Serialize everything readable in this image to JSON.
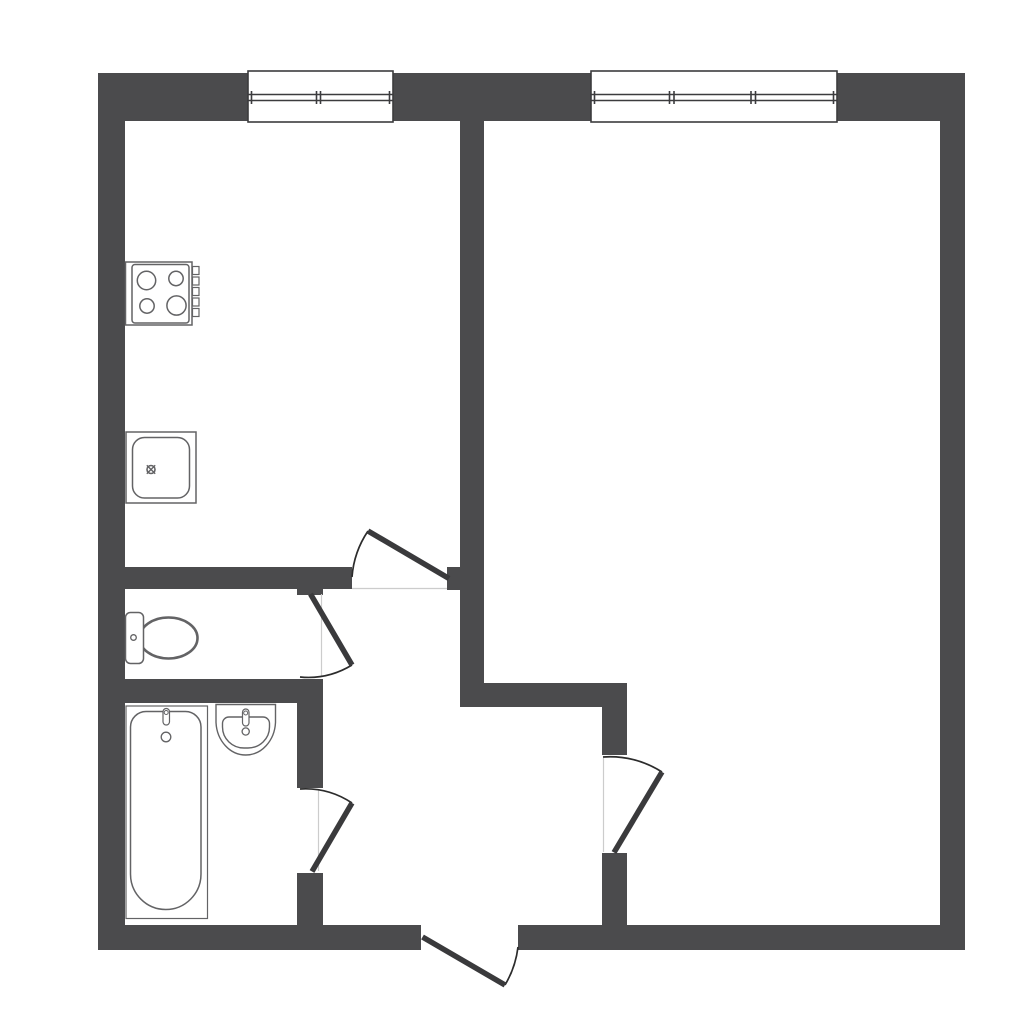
{
  "page": {
    "kind": "architectural-floor-plan",
    "text_content": "none"
  },
  "colors": {
    "background": "#ffffff",
    "wall": "#4b4b4d",
    "door_leaf": "#3a3a3c",
    "door_arc": "#2c2c2c",
    "window_frame": "#3c3c3e",
    "fixture_stroke": "#636365",
    "jamb_line": "#cccccc",
    "fixture_fill": "#ffffff"
  },
  "drawing": {
    "canvas": {
      "width": 1024,
      "height": 1024,
      "viewBox": "0 0 1024 1024"
    },
    "layers": [
      {
        "name": "walls",
        "style": {
          "fill": "#4b4b4d",
          "stroke": "none"
        },
        "shapes": [
          {
            "tag": "rect",
            "name": "wall-exterior-top",
            "attrs": {
              "x": 98,
              "y": 73,
              "width": 867,
              "height": 48
            }
          },
          {
            "tag": "rect",
            "name": "wall-exterior-left",
            "attrs": {
              "x": 98,
              "y": 73,
              "width": 27,
              "height": 877
            }
          },
          {
            "tag": "rect",
            "name": "wall-exterior-right",
            "attrs": {
              "x": 940,
              "y": 73,
              "width": 25,
              "height": 877
            }
          },
          {
            "tag": "rect",
            "name": "wall-exterior-bottom-left",
            "attrs": {
              "x": 98,
              "y": 925,
              "width": 323,
              "height": 25
            }
          },
          {
            "tag": "rect",
            "name": "wall-exterior-bottom-right",
            "attrs": {
              "x": 518,
              "y": 925,
              "width": 447,
              "height": 25
            }
          },
          {
            "tag": "rect",
            "name": "wall-core-vertical",
            "attrs": {
              "x": 460,
              "y": 121,
              "width": 24,
              "height": 586
            }
          },
          {
            "tag": "rect",
            "name": "wall-kitchen-door-stub",
            "attrs": {
              "x": 447,
              "y": 567,
              "width": 13,
              "height": 23
            }
          },
          {
            "tag": "rect",
            "name": "wall-kitchen-bathroom",
            "attrs": {
              "x": 98,
              "y": 567,
              "width": 254,
              "height": 22
            }
          },
          {
            "tag": "rect",
            "name": "wall-toilet-jamb-top",
            "attrs": {
              "x": 297,
              "y": 589,
              "width": 26,
              "height": 6
            }
          },
          {
            "tag": "rect",
            "name": "wall-toilet-bathroom",
            "attrs": {
              "x": 98,
              "y": 679,
              "width": 222,
              "height": 24
            }
          },
          {
            "tag": "rect",
            "name": "wall-bathroom-hall-upper",
            "attrs": {
              "x": 297,
              "y": 679,
              "width": 26,
              "height": 109
            }
          },
          {
            "tag": "rect",
            "name": "wall-bathroom-hall-lower",
            "attrs": {
              "x": 297,
              "y": 873,
              "width": 26,
              "height": 52
            }
          },
          {
            "tag": "rect",
            "name": "wall-hall-room",
            "attrs": {
              "x": 460,
              "y": 683,
              "width": 167,
              "height": 24
            }
          },
          {
            "tag": "rect",
            "name": "wall-room-hall-upper",
            "attrs": {
              "x": 602,
              "y": 707,
              "width": 25,
              "height": 48
            }
          },
          {
            "tag": "rect",
            "name": "wall-room-hall-lower",
            "attrs": {
              "x": 602,
              "y": 853,
              "width": 25,
              "height": 72
            }
          }
        ]
      },
      {
        "name": "windows",
        "style": {
          "stroke": "#3c3c3e",
          "stroke-width": 1.6,
          "fill": "none"
        },
        "shapes": [
          {
            "tag": "rect",
            "name": "window-kitchen-frame",
            "attrs": {
              "x": 248,
              "y": 71,
              "width": 145,
              "height": 51,
              "fill": "#ffffff"
            }
          },
          {
            "tag": "line",
            "name": "window-kitchen-glass-upper",
            "attrs": {
              "x1": 248,
              "y1": 94.5,
              "x2": 393,
              "y2": 94.5
            }
          },
          {
            "tag": "line",
            "name": "window-kitchen-glass-lower",
            "attrs": {
              "x1": 248,
              "y1": 100.5,
              "x2": 393,
              "y2": 100.5
            }
          },
          {
            "tag": "line",
            "name": "window-kitchen-mullion-1",
            "attrs": {
              "x1": 251.5,
              "y1": 91,
              "x2": 251.5,
              "y2": 104
            }
          },
          {
            "tag": "line",
            "name": "window-kitchen-mullion-2",
            "attrs": {
              "x1": 316.5,
              "y1": 91,
              "x2": 316.5,
              "y2": 104
            }
          },
          {
            "tag": "line",
            "name": "window-kitchen-mullion-3",
            "attrs": {
              "x1": 320.5,
              "y1": 91,
              "x2": 320.5,
              "y2": 104
            }
          },
          {
            "tag": "line",
            "name": "window-kitchen-mullion-4",
            "attrs": {
              "x1": 389.5,
              "y1": 91,
              "x2": 389.5,
              "y2": 104
            }
          },
          {
            "tag": "rect",
            "name": "window-room-frame",
            "attrs": {
              "x": 591,
              "y": 71,
              "width": 246,
              "height": 51,
              "fill": "#ffffff"
            }
          },
          {
            "tag": "line",
            "name": "window-room-glass-upper",
            "attrs": {
              "x1": 591,
              "y1": 94.5,
              "x2": 837,
              "y2": 94.5
            }
          },
          {
            "tag": "line",
            "name": "window-room-glass-lower",
            "attrs": {
              "x1": 591,
              "y1": 100.5,
              "x2": 837,
              "y2": 100.5
            }
          },
          {
            "tag": "line",
            "name": "window-room-mullion-1",
            "attrs": {
              "x1": 594.5,
              "y1": 91,
              "x2": 594.5,
              "y2": 104
            }
          },
          {
            "tag": "line",
            "name": "window-room-mullion-2",
            "attrs": {
              "x1": 669.5,
              "y1": 91,
              "x2": 669.5,
              "y2": 104
            }
          },
          {
            "tag": "line",
            "name": "window-room-mullion-3",
            "attrs": {
              "x1": 674,
              "y1": 91,
              "x2": 674,
              "y2": 104
            }
          },
          {
            "tag": "line",
            "name": "window-room-mullion-4",
            "attrs": {
              "x1": 751,
              "y1": 91,
              "x2": 751,
              "y2": 104
            }
          },
          {
            "tag": "line",
            "name": "window-room-mullion-5",
            "attrs": {
              "x1": 755.5,
              "y1": 91,
              "x2": 755.5,
              "y2": 104
            }
          },
          {
            "tag": "line",
            "name": "window-room-mullion-6",
            "attrs": {
              "x1": 833.5,
              "y1": 91,
              "x2": 833.5,
              "y2": 104
            }
          }
        ]
      },
      {
        "name": "door-jambs",
        "style": {
          "stroke": "#cccccc",
          "stroke-width": 1.2,
          "fill": "none"
        },
        "shapes": [
          {
            "tag": "line",
            "name": "jamb-kitchen-door",
            "attrs": {
              "x1": 352,
              "y1": 588.5,
              "x2": 447,
              "y2": 588.5
            }
          },
          {
            "tag": "line",
            "name": "jamb-toilet-door",
            "attrs": {
              "x1": 321.5,
              "y1": 594,
              "x2": 321.5,
              "y2": 677
            }
          },
          {
            "tag": "line",
            "name": "jamb-bathroom-door",
            "attrs": {
              "x1": 318.5,
              "y1": 789,
              "x2": 318.5,
              "y2": 871
            }
          },
          {
            "tag": "line",
            "name": "jamb-room-door",
            "attrs": {
              "x1": 603.5,
              "y1": 758,
              "x2": 603.5,
              "y2": 852
            }
          }
        ]
      },
      {
        "name": "door-swings",
        "style": {
          "stroke": "#2c2c2c",
          "stroke-width": 1.7,
          "fill": "none"
        },
        "shapes": [
          {
            "tag": "path",
            "name": "swing-arc-kitchen-door",
            "attrs": {
              "d": "M 368 531 A 95 95 0 0 0 352 577"
            }
          },
          {
            "tag": "path",
            "name": "swing-arc-toilet-door",
            "attrs": {
              "d": "M 352 665 A 84 84 0 0 1 300 677"
            }
          },
          {
            "tag": "path",
            "name": "swing-arc-bathroom-door",
            "attrs": {
              "d": "M 352 803 A 84 84 0 0 0 300 789"
            }
          },
          {
            "tag": "path",
            "name": "swing-arc-room-door",
            "attrs": {
              "d": "M 662 772 A 96 96 0 0 0 603 757"
            }
          },
          {
            "tag": "path",
            "name": "swing-arc-entry-door",
            "attrs": {
              "d": "M 505 985 A 96 96 0 0 0 518 947"
            }
          }
        ]
      },
      {
        "name": "door-leaves",
        "style": {
          "stroke": "#3a3a3c",
          "stroke-width": 5.5,
          "fill": "none",
          "stroke-linecap": "butt"
        },
        "shapes": [
          {
            "tag": "line",
            "name": "leaf-kitchen-door",
            "attrs": {
              "x1": 449,
              "y1": 578.5,
              "x2": 368,
              "y2": 531
            }
          },
          {
            "tag": "line",
            "name": "leaf-toilet-door",
            "attrs": {
              "x1": 310.5,
              "y1": 594,
              "x2": 352,
              "y2": 665
            }
          },
          {
            "tag": "line",
            "name": "leaf-bathroom-door",
            "attrs": {
              "x1": 312,
              "y1": 871.5,
              "x2": 352,
              "y2": 803
            }
          },
          {
            "tag": "line",
            "name": "leaf-room-door",
            "attrs": {
              "x1": 614,
              "y1": 852.5,
              "x2": 662,
              "y2": 772
            }
          },
          {
            "tag": "line",
            "name": "leaf-entry-door",
            "attrs": {
              "x1": 422.5,
              "y1": 937,
              "x2": 505,
              "y2": 985
            }
          }
        ]
      },
      {
        "name": "fixtures",
        "style": {
          "stroke": "#636365",
          "stroke-width": 1.5,
          "fill": "#ffffff"
        },
        "shapes": [
          {
            "tag": "rect",
            "name": "stove-body",
            "attrs": {
              "x": 125.5,
              "y": 262,
              "width": 66.5,
              "height": 63
            }
          },
          {
            "tag": "rect",
            "name": "stove-top-panel",
            "attrs": {
              "x": 132,
              "y": 264.5,
              "width": 57,
              "height": 58.5,
              "rx": 3
            }
          },
          {
            "tag": "circle",
            "name": "stove-burner-1",
            "attrs": {
              "cx": 146.5,
              "cy": 280.5,
              "r": 9.2
            }
          },
          {
            "tag": "circle",
            "name": "stove-burner-2",
            "attrs": {
              "cx": 176,
              "cy": 278.5,
              "r": 7.2
            }
          },
          {
            "tag": "circle",
            "name": "stove-burner-3",
            "attrs": {
              "cx": 147,
              "cy": 306,
              "r": 7.2
            }
          },
          {
            "tag": "circle",
            "name": "stove-burner-4",
            "attrs": {
              "cx": 176.5,
              "cy": 305.5,
              "r": 9.6
            }
          },
          {
            "tag": "rect",
            "name": "stove-knob-1",
            "attrs": {
              "x": 192.5,
              "y": 266.5,
              "width": 6.5,
              "height": 8,
              "stroke-width": 1.2
            }
          },
          {
            "tag": "rect",
            "name": "stove-knob-2",
            "attrs": {
              "x": 192.5,
              "y": 277,
              "width": 6.5,
              "height": 8,
              "stroke-width": 1.2
            }
          },
          {
            "tag": "rect",
            "name": "stove-knob-3",
            "attrs": {
              "x": 192.5,
              "y": 287.5,
              "width": 6.5,
              "height": 8,
              "stroke-width": 1.2
            }
          },
          {
            "tag": "rect",
            "name": "stove-knob-4",
            "attrs": {
              "x": 192.5,
              "y": 298,
              "width": 6.5,
              "height": 8,
              "stroke-width": 1.2
            }
          },
          {
            "tag": "rect",
            "name": "stove-knob-5",
            "attrs": {
              "x": 192.5,
              "y": 308.5,
              "width": 6.5,
              "height": 8,
              "stroke-width": 1.2
            }
          },
          {
            "tag": "rect",
            "name": "kitchen-sink-counter",
            "attrs": {
              "x": 126,
              "y": 432,
              "width": 70,
              "height": 71
            }
          },
          {
            "tag": "rect",
            "name": "kitchen-sink-basin",
            "attrs": {
              "x": 132.5,
              "y": 437.5,
              "width": 57,
              "height": 60.5,
              "rx": 12
            }
          },
          {
            "tag": "circle",
            "name": "kitchen-sink-drain",
            "attrs": {
              "cx": 151,
              "cy": 469.5,
              "r": 4,
              "stroke-width": 1.6
            }
          },
          {
            "tag": "line",
            "name": "kitchen-sink-drain-cross-1",
            "attrs": {
              "x1": 146.8,
              "y1": 465.3,
              "x2": 155.2,
              "y2": 473.7,
              "stroke-width": 1.4
            }
          },
          {
            "tag": "line",
            "name": "kitchen-sink-drain-cross-2",
            "attrs": {
              "x1": 155.2,
              "y1": 465.3,
              "x2": 146.8,
              "y2": 473.7,
              "stroke-width": 1.4
            }
          },
          {
            "tag": "ellipse",
            "name": "toilet-bowl",
            "attrs": {
              "cx": 168.5,
              "cy": 638,
              "rx": 29,
              "ry": 20.5,
              "stroke-width": 2.6
            }
          },
          {
            "tag": "rect",
            "name": "toilet-tank",
            "attrs": {
              "x": 125.5,
              "y": 612.5,
              "width": 18,
              "height": 51,
              "rx": 5
            }
          },
          {
            "tag": "circle",
            "name": "toilet-flush-button",
            "attrs": {
              "cx": 133.5,
              "cy": 637.5,
              "r": 2.8,
              "stroke-width": 1.3
            }
          },
          {
            "tag": "rect",
            "name": "bathtub-deck",
            "attrs": {
              "x": 126,
              "y": 706,
              "width": 81.5,
              "height": 212.5,
              "stroke-width": 1.2
            }
          },
          {
            "tag": "path",
            "name": "bathtub-basin",
            "attrs": {
              "d": "M 146 711.5 L 185.5 711.5 A 15.5 15.5 0 0 1 201 727 L 201 874 A 35.3 35.5 0 0 1 165.7 909.5 A 35.3 35.5 0 0 1 130.5 874 L 130.5 727 A 15.5 15.5 0 0 1 146 711.5 Z"
            }
          },
          {
            "tag": "rect",
            "name": "bathtub-faucet",
            "attrs": {
              "x": 163,
              "y": 708.5,
              "width": 6.5,
              "height": 16.5,
              "rx": 3.2,
              "stroke-width": 1.2
            }
          },
          {
            "tag": "circle",
            "name": "bathtub-faucet-cap",
            "attrs": {
              "cx": 166.2,
              "cy": 712.5,
              "r": 2,
              "stroke-width": 1
            }
          },
          {
            "tag": "circle",
            "name": "bathtub-drain",
            "attrs": {
              "cx": 166,
              "cy": 737,
              "r": 4.8,
              "stroke-width": 1.3
            }
          },
          {
            "tag": "path",
            "name": "bathroom-sink-outer",
            "attrs": {
              "d": "M 216 704.5 L 216 722.5 A 29.8 34.5 0 0 0 275.5 722.5 L 275.5 704.5 Z",
              "stroke-width": 1.4
            }
          },
          {
            "tag": "path",
            "name": "bathroom-sink-basin",
            "attrs": {
              "d": "M 229 717 L 263 717 A 6.5 6.5 0 0 1 269.5 723.5 L 269.5 727 A 21.5 21 0 0 1 248 748 L 244 748 A 21.5 21 0 0 1 222.5 727 L 222.5 723.5 A 6.5 6.5 0 0 1 229 717 Z",
              "stroke-width": 1.4
            }
          },
          {
            "tag": "rect",
            "name": "bathroom-sink-faucet",
            "attrs": {
              "x": 242.5,
              "y": 709,
              "width": 6.5,
              "height": 17,
              "rx": 3.2,
              "stroke-width": 1.2
            }
          },
          {
            "tag": "circle",
            "name": "bathroom-sink-faucet-cap",
            "attrs": {
              "cx": 245.7,
              "cy": 713,
              "r": 2,
              "stroke-width": 1
            }
          },
          {
            "tag": "circle",
            "name": "bathroom-sink-drain",
            "attrs": {
              "cx": 245.7,
              "cy": 731.5,
              "r": 3.6,
              "stroke-width": 1.3
            }
          }
        ]
      }
    ]
  }
}
